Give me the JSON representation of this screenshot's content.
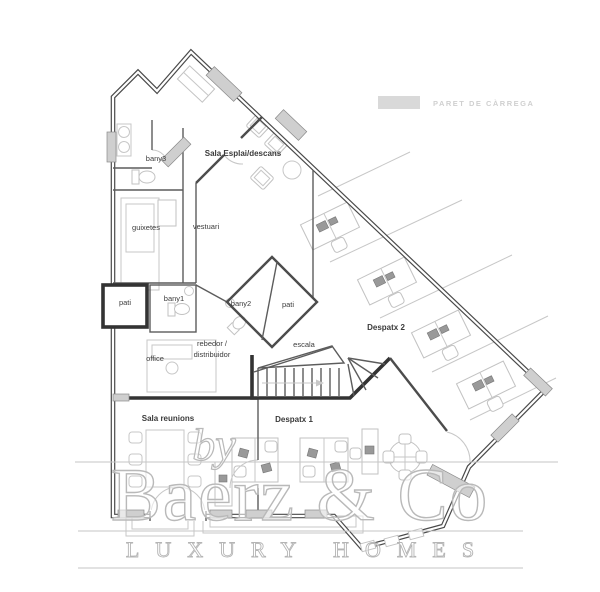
{
  "legend": {
    "label": "PARET DE CÀRREGA",
    "swatch_color": "#d9d9d9"
  },
  "rooms": [
    {
      "id": "bany3",
      "label": "bany3"
    },
    {
      "id": "sala-esplai",
      "label": "Sala Esplai/descans"
    },
    {
      "id": "guixetes",
      "label": "guixetes"
    },
    {
      "id": "vestuari",
      "label": "vestuari"
    },
    {
      "id": "pati-left",
      "label": "pati"
    },
    {
      "id": "bany1",
      "label": "bany1"
    },
    {
      "id": "bany2",
      "label": "bany2"
    },
    {
      "id": "pati-right",
      "label": "pati"
    },
    {
      "id": "office",
      "label": "office"
    },
    {
      "id": "rebedor",
      "label": "rebedor /",
      "label2": "distribuidor"
    },
    {
      "id": "escala",
      "label": "escala"
    },
    {
      "id": "despatx2",
      "label": "Despatx 2"
    },
    {
      "id": "sala-reunions",
      "label": "Sala reunions"
    },
    {
      "id": "despatx1",
      "label": "Despatx 1"
    }
  ],
  "watermark": {
    "by": "by",
    "brand": "Baerz & Co",
    "tagline": "LUXURY HOMES"
  },
  "colors": {
    "wall": "#4a4a4a",
    "load_bearing_fill": "#cfcfcf",
    "furniture": "#c7c7c7",
    "label_text": "#3c3c3c",
    "watermark": "#b9b9b9",
    "legend_text": "#d0d0d0"
  }
}
